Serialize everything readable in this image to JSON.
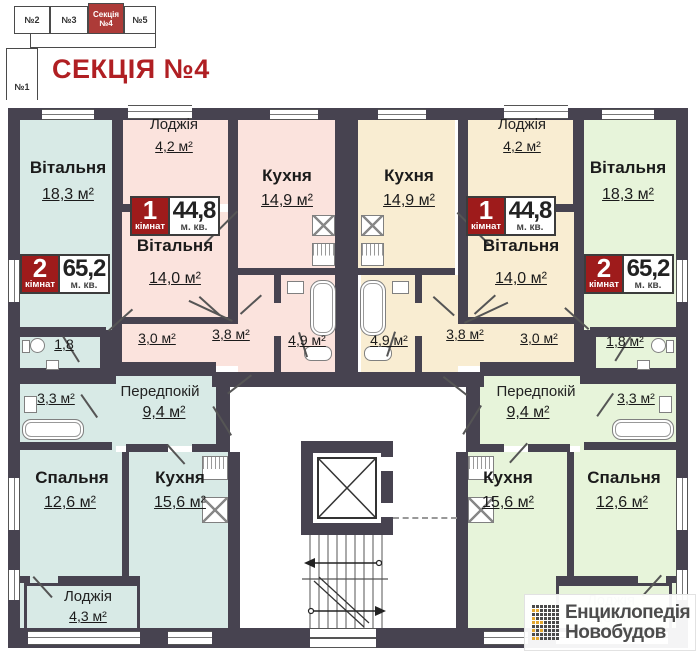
{
  "header": {
    "schematic": {
      "sections": [
        {
          "label": "№2"
        },
        {
          "label": "№3"
        },
        {
          "label": "Секція №4",
          "active": true
        },
        {
          "label": "№5"
        },
        {
          "label": "№1"
        }
      ]
    },
    "title": "СЕКЦІЯ №4"
  },
  "badges": {
    "one": {
      "num": "1",
      "rooms": "кімнат",
      "area": "44,8",
      "unit": "м. кв."
    },
    "two": {
      "num": "2",
      "rooms": "кімнат",
      "area": "65,2",
      "unit": "м. кв."
    }
  },
  "apartments": {
    "teal": {
      "living": "Вітальня",
      "living_area": "18,3 м²",
      "wc_area": "1,8",
      "bath_area": "3,3 м²",
      "hall": "Передпокій",
      "hall_area": "9,4 м²",
      "bedroom": "Спальня",
      "bedroom_area": "12,6 м²",
      "kitchen": "Кухня",
      "kitchen_area": "15,6 м²",
      "loggia": "Лоджія",
      "loggia_area": "4,3 м²"
    },
    "pink": {
      "loggia": "Лоджія",
      "loggia_area": "4,2 м²",
      "kitchen": "Кухня",
      "kitchen_area": "14,9 м²",
      "living": "Вітальня",
      "living_area": "14,0 м²",
      "hall_area": "3,0 м²",
      "corridor_area": "3,8 м²",
      "bath_area": "4,9 м²"
    },
    "cream": {
      "loggia": "Лоджія",
      "loggia_area": "4,2 м²",
      "kitchen": "Кухня",
      "kitchen_area": "14,9 м²",
      "living": "Вітальня",
      "living_area": "14,0 м²",
      "hall_area": "3,0 м²",
      "corridor_area": "3,8 м²",
      "bath_area": "4,9 м²"
    },
    "green": {
      "living": "Вітальня",
      "living_area": "18,3 м²",
      "wc_area": "1,8 м²",
      "bath_area": "3,3 м²",
      "hall": "Передпокій",
      "hall_area": "9,4 м²",
      "kitchen": "Кухня",
      "kitchen_area": "15,6 м²",
      "bedroom": "Спальня",
      "bedroom_area": "12,6 м²",
      "loggia": "Лоджія",
      "loggia_area": "4,3 м²"
    }
  },
  "ghost_loggia": {
    "name": "Лоджія",
    "area": "4,3 м²"
  },
  "colors": {
    "wall": "#474350",
    "teal": "#d8eae6",
    "pink": "#fbe3dd",
    "cream": "#f9edd2",
    "green": "#e7f4da",
    "badge_red": "#9e1b1b",
    "title_red": "#b01f23",
    "logo_yellow": "#e3a72f"
  },
  "logo": {
    "line1": "Енциклопедія",
    "line2": "Новобудов",
    "pattern": [
      "DDDDDDD",
      "YYDDDDD",
      "DDDDDDD",
      "YDDDDDD",
      "YYYDDDD",
      "DDDDDDD",
      "YDYDDDD",
      "DDDDDDD",
      "YYDDDDD"
    ]
  }
}
